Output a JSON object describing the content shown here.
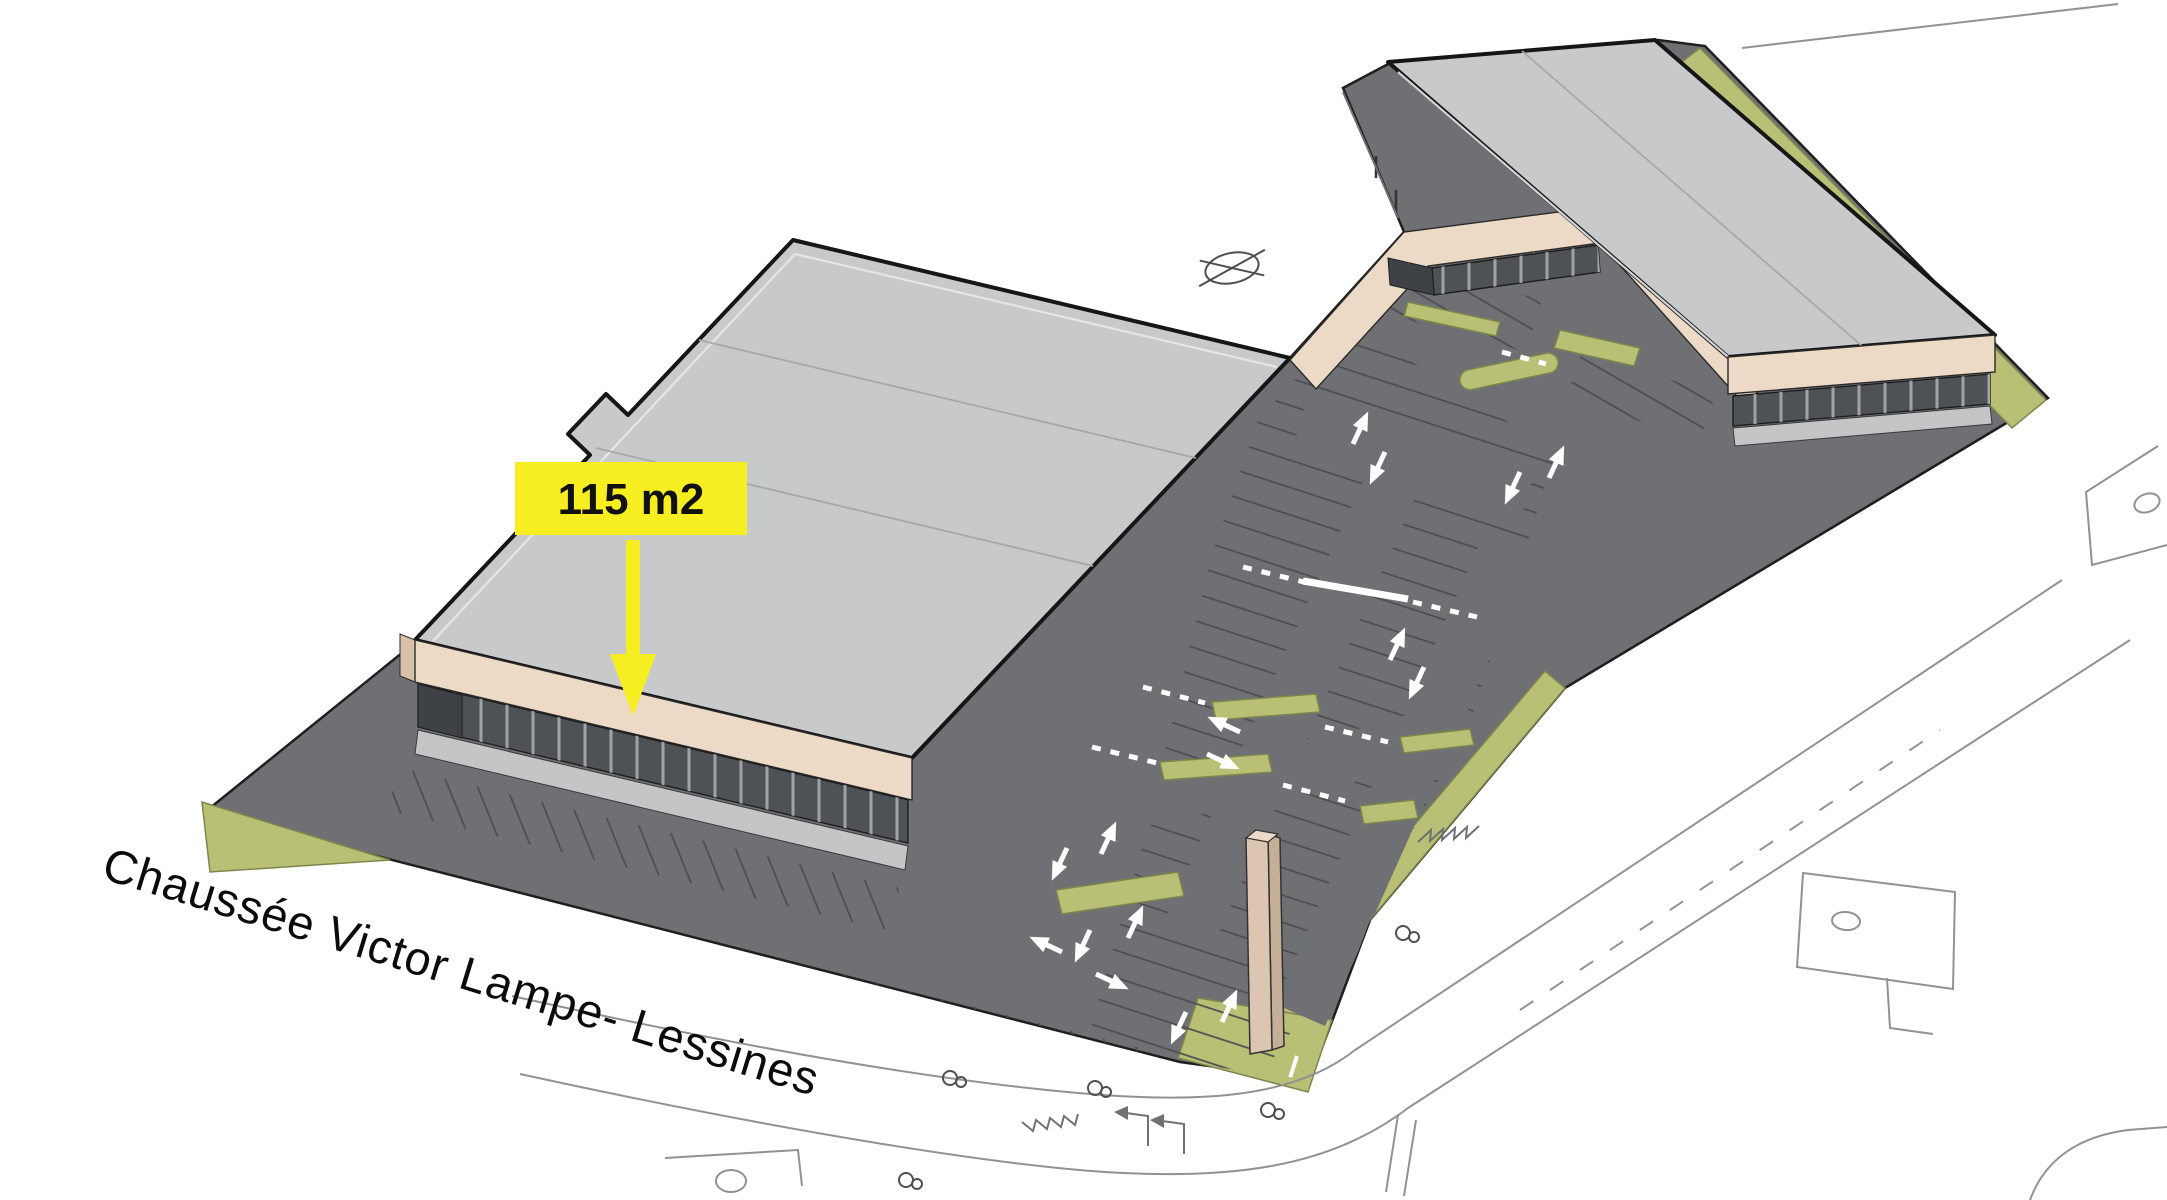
{
  "labels": {
    "area": "115 m2",
    "street": "Chaussée Victor Lampe- Lessines"
  },
  "symbols": {
    "survey_marker": "crossed-ellipse",
    "tree": "paired-circles",
    "area_pointer": "down-arrow"
  },
  "colors": {
    "background": "#ffffff",
    "pavement": "#6e7073",
    "pavement_edge": "#1f1f1f",
    "stall_line": "#4b4d50",
    "roof": "#c7c9cb",
    "roof_line": "#a6a8aa",
    "roof_edge": "#161616",
    "parapet_highlight": "#e8e9ea",
    "fascia": "#ecd9c6",
    "fascia_shade": "#d9c0a9",
    "glazing": "#4e5256",
    "glazing_dark": "#3e4246",
    "mullion": "#9fa3a7",
    "sidewalk": "#c3c5c7",
    "green": "#b9bf75",
    "green_edge": "#7e864d",
    "label_yellow": "#f6ee20",
    "label_text": "#111111",
    "street_text": "#0b0b0b",
    "marking": "#ffffff",
    "outline": "#909294",
    "pylon_front": "#dcc6b2",
    "pylon_side": "#c7ae97",
    "pylon_top": "#ead9c8"
  }
}
